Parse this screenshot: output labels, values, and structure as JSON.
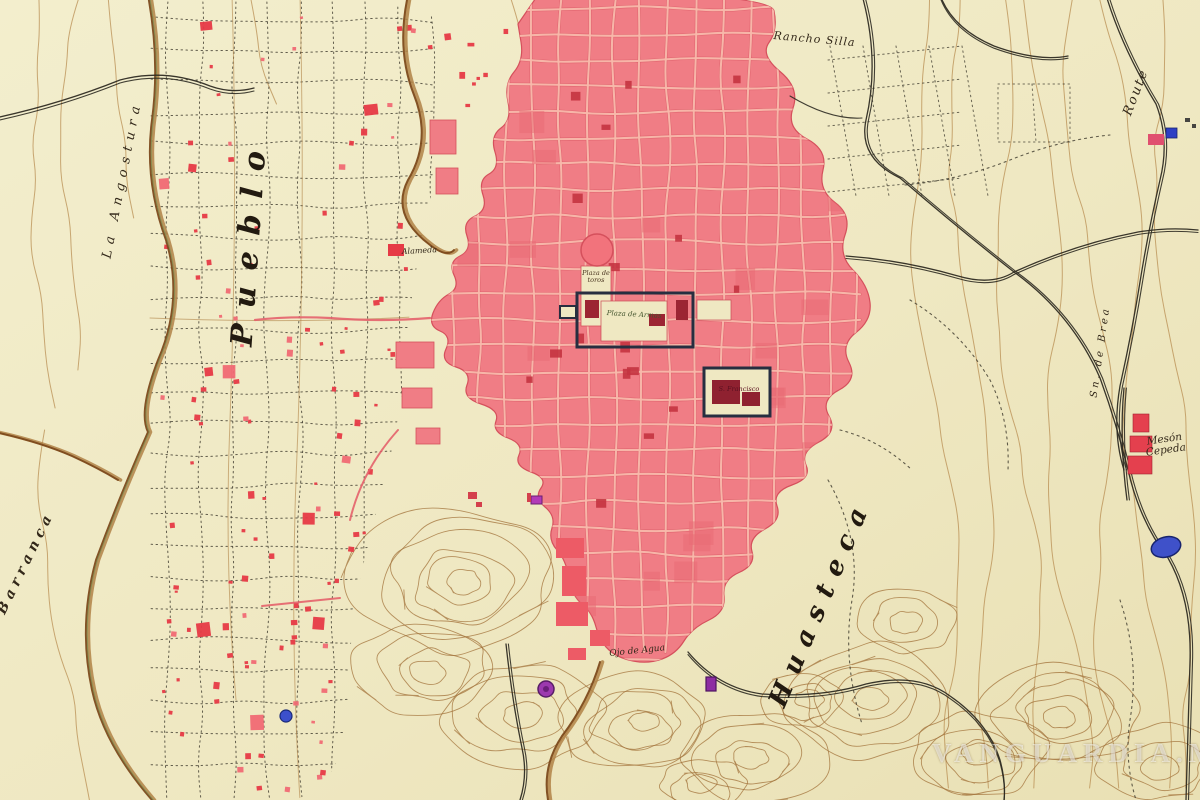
{
  "map": {
    "description": "Historical hand-drawn city plan with pink urban blocks, pueblo lot grid, ravines, roads and contoured hills",
    "watermark": "VANGUARDIA.MX",
    "labels": {
      "rancho_silla": "Rancho Silla",
      "route": "Route",
      "la_angostura": "La Angostura",
      "barranca": "Barranca",
      "pueblo": "Pueblo",
      "huasteca": "Huasteca",
      "meson_cepeda": "Mesón Cepeda",
      "sn_de_brea": "Sn. de Brea",
      "ojo_de_agua": "Ojo de Agua",
      "plaza_de_toros": "Plaza de toros",
      "plaza_de_armas": "Plaza de Armas",
      "s_francisco": "S. Francisco",
      "alameda": "Alameda"
    },
    "colors": {
      "paper": "#efe8c2",
      "paper_light": "#f3eecd",
      "city_block_pink": "#f07d85",
      "city_block_dark": "#ea6b74",
      "street_pink": "#f8b9ab",
      "block_edge": "#d5505c",
      "building_red": "#e63a46",
      "building_dark_red": "#9c2533",
      "contour_brown": "#b5884a",
      "hill_brown": "#a1713a",
      "stream_brown": "#7c4a1c",
      "stream_light": "#b08347",
      "stream_green": "#7f8f52",
      "road_black": "#2e2b22",
      "grid_ink": "#3c382c",
      "marker_purple": "#9c39ae",
      "water_blue": "#3f51c9",
      "ink": "#2b2418"
    }
  }
}
